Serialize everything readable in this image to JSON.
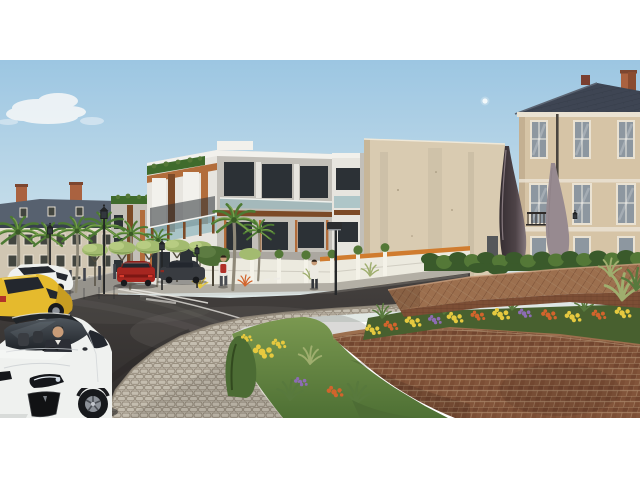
{
  "scene": {
    "type": "architectural-render-photo",
    "description": "Daytime architectural rendering: a modern white apartment building with wood fins and glass balconies between classical slate-roofed buildings, palm trees and lantern street lamps along a wet asphalt street, a landscaped two-tier brick roundabout with flower beds, a cobblestone ring path and twin dark teardrop sculptures, a small moon in the blue sky, parked cars and a white Tesla sedan with a suited driver in the foreground, and two pedestrians on the far sidewalk.",
    "letterbox": {
      "top_px": 60,
      "bottom_px": 62,
      "content_height_px": 358
    },
    "sky": {
      "moon_visible": true,
      "cloud": "small cumulus upper-left"
    },
    "buildings": [
      {
        "name": "classical-left",
        "style": "classical, slate roof, orange chimneys, shuttered windows",
        "position": "left"
      },
      {
        "name": "modern-apartments",
        "style": "modern white volumes, timber fins and fascias, teal glass balconies, green roof planting strips",
        "position": "center-left"
      },
      {
        "name": "blank-side-wall",
        "style": "tall plain beige side wall",
        "position": "center"
      },
      {
        "name": "classical-right",
        "style": "classical, hipped dark slate roof, orange chimney, tall white-framed windows, iron balcony, downpipe, wall lantern",
        "position": "right"
      }
    ],
    "monument": {
      "name": "twin-teardrop-sculptures",
      "material": "dark bronze",
      "count": 2
    },
    "roundabout": {
      "tiers": 2,
      "upper_wall": "diagonal-laid brick cap",
      "lower_wall": "curved running-bond brick wall",
      "planting": [
        "clipped hedge",
        "yellow daisies",
        "orange lilies",
        "purple flowers",
        "juniper shrub",
        "ornamental grasses"
      ],
      "ring_path": "grey cobblestone walkway"
    },
    "vehicles": [
      {
        "name": "tesla-sedan",
        "color": "white",
        "position": "foreground-left",
        "detail": "driver in dark suit, black grille, headlight visible"
      },
      {
        "name": "yellow-hatchback",
        "color": "yellow",
        "position": "left, behind tesla"
      },
      {
        "name": "white-compact",
        "color": "white",
        "position": "far left curb"
      },
      {
        "name": "red-hatchback",
        "color": "red",
        "position": "middle distance, rear view"
      },
      {
        "name": "dark-saloon",
        "color": "dark grey",
        "position": "middle distance"
      }
    ],
    "pedestrians": [
      {
        "name": "walker-red-backpack",
        "detail": "white top, red backpack, dark shorts"
      },
      {
        "name": "walker-white-shirt",
        "detail": "white shirt, dark trousers"
      }
    ],
    "street_furniture": [
      "lantern street lamps",
      "modern box-head lamp",
      "median bollards",
      "white fence with planter topiaries",
      "white wall with orange stripe",
      "pollarded light-green trees",
      "royal palm trees"
    ],
    "road": {
      "surface": "wet asphalt with reflections",
      "markings": "white curved lane lines and give-way dashes"
    }
  },
  "palette": {
    "white": "#ffffff",
    "sky_top": "#9cc6e2",
    "sky_mid": "#c2dbe9",
    "sky_low": "#e2e8e4",
    "cloud": "#f3f6f7",
    "lb_facade": "#d0c6b2",
    "lb_facade_dark": "#bcb09a",
    "lb_roof": "#57616f",
    "lb_roof_dark": "#434c59",
    "lb_win": "#42453f",
    "lb_trim": "#e7e0d2",
    "chimney": "#aa6240",
    "palm_frond": "#4d7a33",
    "palm_frond_light": "#79a24c",
    "palm_trunk": "#8e8878",
    "tree_light": "#a3bb70",
    "tree_dark": "#4c6c34",
    "mb_white": "#e7e5df",
    "mb_light": "#f2f1ec",
    "mb_shadow": "#c2bfb8",
    "mb_grey": "#9b9790",
    "wood": "#b26d3b",
    "wood_dark": "#7c4a27",
    "win_dark": "#2c3136",
    "glass_teal": "#8fb6bc",
    "roof_green": "#3f6b2c",
    "bw_wall": "#d9cbb1",
    "bw_shade": "#c7b698",
    "rb_facade": "#d6c4a6",
    "rb_shade": "#c4b092",
    "rb_roof": "#3e4553",
    "rb_roof_hi": "#5b6472",
    "rb_trim": "#eae2d2",
    "rb_glass": "#8d97a0",
    "iron": "#2e2a28",
    "sculpt_dark": "#332c30",
    "sculpt": "#4e4347",
    "sculpt_hi": "#978a90",
    "hedge": "#3a5a2b",
    "shrub": "#547837",
    "grass_hi": "#7a9850",
    "grass_lo": "#4e7034",
    "grass_dry": "#9fae6e",
    "leaf": "#58793d",
    "brick_hi": "#9c6f4e",
    "brick_mid": "#7c4e35",
    "brick_dark": "#5a3422",
    "mortar": "#a98668",
    "flower_yellow": "#e6c93f",
    "flower_orange": "#d2642c",
    "flower_purple": "#8d6cb4",
    "cobble": "#c4bdaf",
    "cobble_dark": "#93897a",
    "sidewalk": "#b3afa5",
    "kerb": "#96938c",
    "road_top": "#45413f",
    "road_bottom": "#2e2b2a",
    "road_wet": "#6b6765",
    "marking": "#eceae4",
    "fence_white": "#eceadf",
    "fence_orange": "#d07c2f",
    "bollard": "#3f434b",
    "car_white": "#eff1ef",
    "car_white_shade": "#c6cbce",
    "car_yellow": "#e5ba2d",
    "car_red": "#a62620",
    "car_red_dark": "#7c1713",
    "car_dark": "#393c41",
    "tyre": "#17191c",
    "glass_dark": "#23272e",
    "rim": "#8d9299",
    "skin": "#c89c78",
    "suit": "#2b2e35",
    "hair": "#2a2018",
    "lamp": "#232526"
  }
}
